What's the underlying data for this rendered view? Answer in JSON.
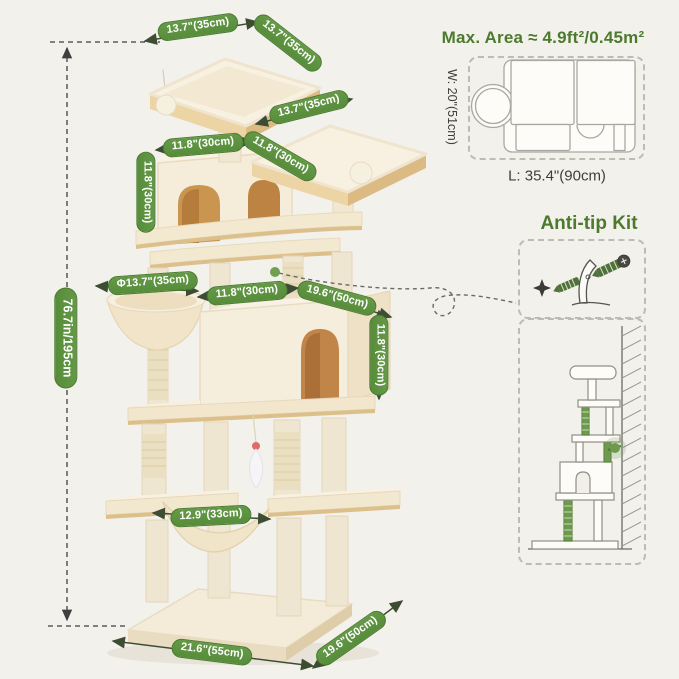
{
  "page": {
    "background_color": "#f3f1eb"
  },
  "colors": {
    "pill_green": "#5d9140",
    "heading_green": "#4c7a2e",
    "arrow_dark_olive": "#3d4d33",
    "dashed_reference": "#3f3f3f",
    "plush_cream": "#f6eedd",
    "board_tan": "#dcc08b",
    "condo_opening_tan": "#c18449"
  },
  "dimensions": {
    "top_platform_width": "13.7\"(35cm)",
    "top_platform_depth": "13.7\"(35cm)",
    "second_platform_width": "13.7\"(35cm)",
    "upper_condo_width": "11.8\"(30cm)",
    "upper_condo_depth": "11.8\"(30cm)",
    "upper_condo_height": "11.8\"(30cm)",
    "basket_diameter": "Φ13.7\"(35cm)",
    "lower_condo_width": "11.8\"(30cm)",
    "lower_condo_depth": "19.6\"(50cm)",
    "lower_condo_height": "11.8\"(30cm)",
    "hammock_width": "12.9\"(33cm)",
    "base_width": "21.6\"(55cm)",
    "base_depth": "19.6\"(50cm)",
    "total_height": "76.7in/195cm"
  },
  "max_area": {
    "title": "Max. Area ≈ 4.9ft²/0.45m²",
    "width_label": "W: 20\"(51cm)",
    "length_label": "L: 35.4\"(90cm)"
  },
  "anti_tip": {
    "title": "Anti-tip Kit"
  }
}
